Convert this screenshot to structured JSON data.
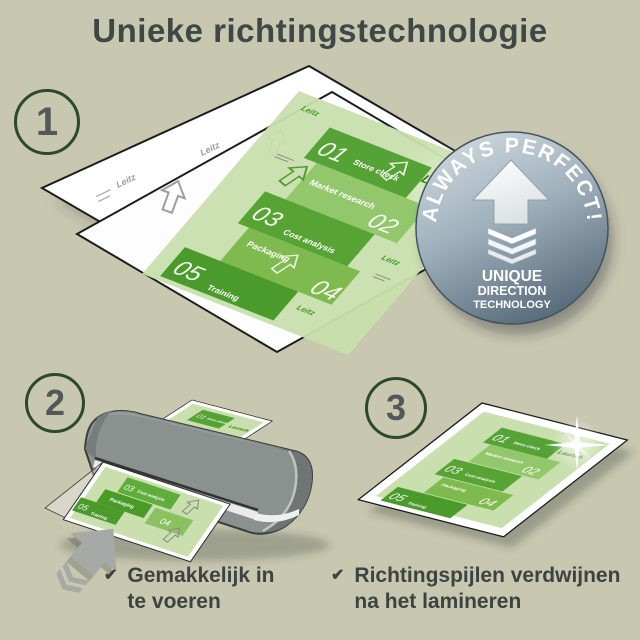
{
  "title": "Unieke richtingstechnologie",
  "steps": [
    {
      "number": "1"
    },
    {
      "number": "2"
    },
    {
      "number": "3"
    }
  ],
  "badge": {
    "arc_text": "ALWAYS PERFECT!",
    "lines": [
      "UNIQUE",
      "DIRECTION",
      "TECHNOLOGY"
    ]
  },
  "doc": {
    "launch": "Launch",
    "watermark": "Leitz",
    "items": [
      {
        "num": "01",
        "label": "Store check"
      },
      {
        "num": "02",
        "label": "Market research"
      },
      {
        "num": "03",
        "label": "Cost analysis"
      },
      {
        "num": "04",
        "label": "Packaging"
      },
      {
        "num": "05",
        "label": "Training"
      }
    ]
  },
  "captions": [
    {
      "check": "✔",
      "lines": [
        "Gemakkelijk in",
        "te voeren"
      ]
    },
    {
      "check": "✔",
      "lines": [
        "Richtingspijlen verdwijnen",
        "na het lamineren"
      ]
    }
  ],
  "colors": {
    "background": "#c8c8b1",
    "title": "#3f4846",
    "green_dark": "#55a336",
    "green_mid": "#8cc162",
    "doc_bg": "#c9dfad",
    "badge_light": "#cdd7dd",
    "badge_dark": "#5a6c7b",
    "machine_gray": "#8b918f",
    "arrow_gray": "#a7a9a6"
  }
}
